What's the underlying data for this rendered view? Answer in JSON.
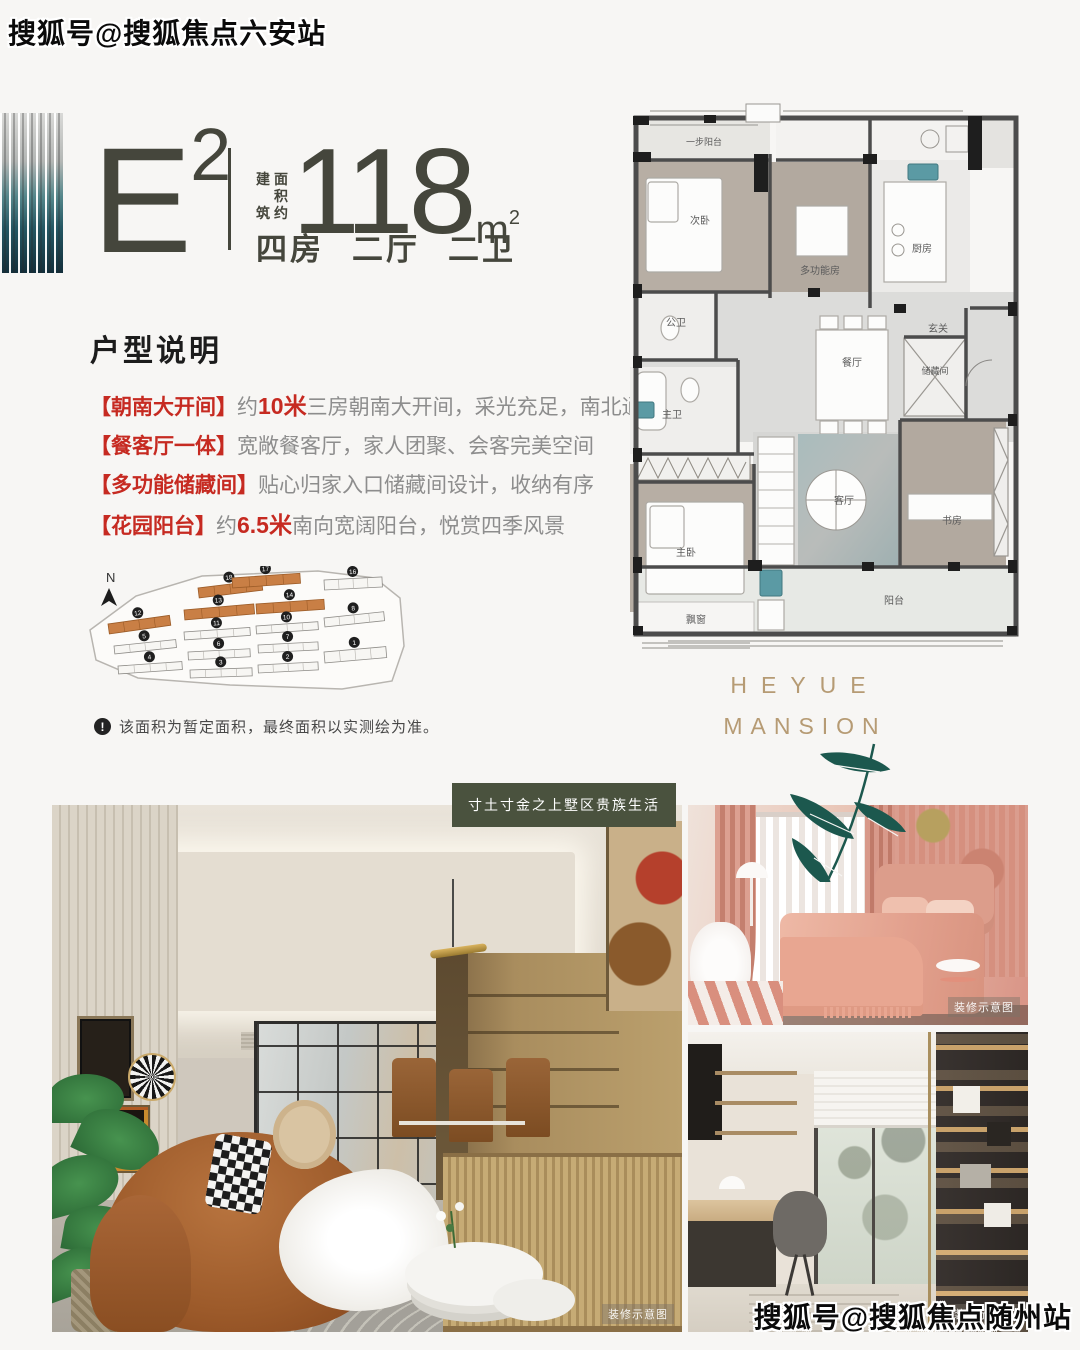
{
  "watermarks": {
    "top_left": "搜狐号@搜狐焦点六安站",
    "bottom_right": "搜狐号@搜狐焦点随州站"
  },
  "header": {
    "unit_letter": "E",
    "unit_exponent": "2",
    "area_label_col1": [
      "建",
      "筑"
    ],
    "area_label_col2": [
      "面",
      "积",
      "约"
    ],
    "area_value": "118",
    "area_unit_letter": "m",
    "area_unit_exponent": "2",
    "layout_tags": [
      "四房",
      "二厅",
      "二卫"
    ]
  },
  "description": {
    "title": "户型说明",
    "items": [
      {
        "label": "【朝南大开间】",
        "pre": "约",
        "highlight": "10米",
        "text": "三房朝南大开间，采光充足，南北通透"
      },
      {
        "label": "【餐客厅一体】",
        "pre": "",
        "highlight": "",
        "text": "宽敞餐客厅，家人团聚、会客完美空间"
      },
      {
        "label": "【多功能储藏间】",
        "pre": "",
        "highlight": "",
        "text": "贴心归家入口储藏间设计，收纳有序"
      },
      {
        "label": "【花园阳台】",
        "pre": "约",
        "highlight": "6.5米",
        "text": "南向宽阔阳台，悦赏四季风景"
      }
    ],
    "note_icon": "!",
    "note": "该面积为暂定面积，最终面积以实测绘为准。"
  },
  "site_plan": {
    "north_label": "N",
    "buildings": [
      {
        "num": "18",
        "x": 118,
        "y": 22,
        "w": 64,
        "h": 10,
        "rot": -7,
        "orange": true
      },
      {
        "num": "17",
        "x": 152,
        "y": 12,
        "w": 68,
        "h": 10,
        "rot": -4,
        "orange": true
      },
      {
        "num": "16",
        "x": 244,
        "y": 14,
        "w": 58,
        "h": 10,
        "rot": -3,
        "orange": false
      },
      {
        "num": "13",
        "x": 104,
        "y": 44,
        "w": 70,
        "h": 10,
        "rot": -5,
        "orange": true
      },
      {
        "num": "14",
        "x": 176,
        "y": 38,
        "w": 68,
        "h": 10,
        "rot": -4,
        "orange": true
      },
      {
        "num": "12",
        "x": 28,
        "y": 58,
        "w": 62,
        "h": 10,
        "rot": -8,
        "orange": true
      },
      {
        "num": "8",
        "x": 244,
        "y": 52,
        "w": 60,
        "h": 9,
        "rot": -6,
        "orange": false
      },
      {
        "num": "11",
        "x": 104,
        "y": 66,
        "w": 66,
        "h": 8,
        "rot": -4,
        "orange": false
      },
      {
        "num": "10",
        "x": 176,
        "y": 60,
        "w": 62,
        "h": 8,
        "rot": -4,
        "orange": false
      },
      {
        "num": "5",
        "x": 34,
        "y": 80,
        "w": 62,
        "h": 8,
        "rot": -6,
        "orange": false
      },
      {
        "num": "6",
        "x": 108,
        "y": 86,
        "w": 62,
        "h": 8,
        "rot": -3,
        "orange": false
      },
      {
        "num": "7",
        "x": 178,
        "y": 79,
        "w": 60,
        "h": 8,
        "rot": -3,
        "orange": false
      },
      {
        "num": "1",
        "x": 244,
        "y": 86,
        "w": 62,
        "h": 11,
        "rot": -5,
        "orange": false
      },
      {
        "num": "4",
        "x": 38,
        "y": 100,
        "w": 64,
        "h": 8,
        "rot": -4,
        "orange": false
      },
      {
        "num": "3",
        "x": 110,
        "y": 104,
        "w": 62,
        "h": 8,
        "rot": -2,
        "orange": false
      },
      {
        "num": "2",
        "x": 178,
        "y": 99,
        "w": 60,
        "h": 8,
        "rot": -3,
        "orange": false
      }
    ]
  },
  "floor_plan": {
    "rooms": {
      "balcony_top": "一步阳台",
      "bedroom2": "次卧",
      "multi_room": "多功能房",
      "kitchen": "厨房",
      "guest_bath": "公卫",
      "foyer": "玄关",
      "dining": "餐厅",
      "storage": "储藏间",
      "master_bath": "主卫",
      "master_bed": "主卧",
      "living": "客厅",
      "study": "书房",
      "balcony": "阳台",
      "bay_window": "飘窗"
    }
  },
  "brand": {
    "line1": "HEYUE",
    "line2": "MANSION"
  },
  "slogan_badge": "寸土寸金之上墅区贵族生活",
  "photo_caption": "装修示意图",
  "colors": {
    "accent_red": "#c62a21",
    "brand_gold": "#b69b74",
    "badge_green": "#4a523e",
    "unit_dark": "#45463c",
    "bamboo_green": "#1c584e",
    "site_orange": "#c97f45"
  }
}
